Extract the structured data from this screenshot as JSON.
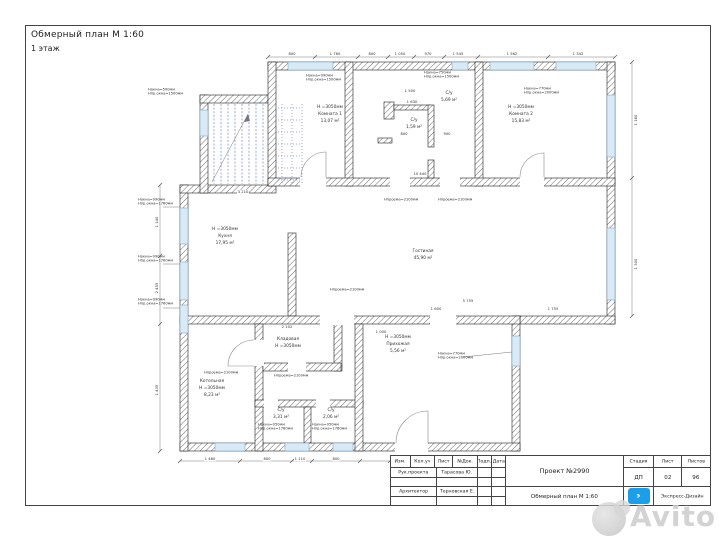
{
  "doc": {
    "title": "Обмерный план М 1:60",
    "subtitle": "1 этаж"
  },
  "plan": {
    "rooms": [
      {
        "l1": "Н =3050мм",
        "l2": "Комната 1",
        "l3": "13,07 м²"
      },
      {
        "l1": "С/у",
        "l2": "1,59 м²"
      },
      {
        "l1": "С/у",
        "l2": "5,69 м²"
      },
      {
        "l1": "Н =3050мм",
        "l2": "Комната 2",
        "l3": "15,83 м²"
      },
      {
        "l1": "Н =3050мм",
        "l2": "Кухня",
        "l3": "17,95 м²"
      },
      {
        "l1": "Гостиная",
        "l2": "45,90 м²"
      },
      {
        "l1": "Кладовая",
        "l2": "Н =3050мм"
      },
      {
        "l1": "Котельная",
        "l2": "Н =3050мм",
        "l3": "8,23 м²"
      },
      {
        "l1": "С/у",
        "l2": "3,31 м²"
      },
      {
        "l1": "С/у",
        "l2": "2,06 м²"
      },
      {
        "l1": "Н =3050мм",
        "l2": "Прихожая",
        "l3": "5,56 м²"
      }
    ],
    "dimensions": [
      {
        "t": "800",
        "x": 292,
        "y": 54
      },
      {
        "t": "1 760",
        "x": 335,
        "y": 54
      },
      {
        "t": "800",
        "x": 372,
        "y": 54
      },
      {
        "t": "1 050",
        "x": 400,
        "y": 54
      },
      {
        "t": "970",
        "x": 428,
        "y": 54
      },
      {
        "t": "1 545",
        "x": 458,
        "y": 54
      },
      {
        "t": "1 562",
        "x": 512,
        "y": 54
      },
      {
        "t": "1 342",
        "x": 578,
        "y": 54
      },
      {
        "t": "1 160",
        "x": 636,
        "y": 120,
        "v": true
      },
      {
        "t": "1 300",
        "x": 636,
        "y": 264,
        "v": true
      },
      {
        "t": "1 140",
        "x": 157,
        "y": 222,
        "v": true
      },
      {
        "t": "2 455",
        "x": 157,
        "y": 288,
        "v": true
      },
      {
        "t": "1 435",
        "x": 157,
        "y": 390,
        "v": true
      },
      {
        "t": "1 480",
        "x": 210,
        "y": 459
      },
      {
        "t": "800",
        "x": 267,
        "y": 459
      },
      {
        "t": "1 110",
        "x": 300,
        "y": 459
      },
      {
        "t": "800",
        "x": 336,
        "y": 459
      },
      {
        "t": "10 440",
        "x": 420,
        "y": 174
      },
      {
        "t": "1 500",
        "x": 410,
        "y": 91
      },
      {
        "t": "1 630",
        "x": 412,
        "y": 102
      },
      {
        "t": "800",
        "x": 404,
        "y": 134
      },
      {
        "t": "900",
        "x": 447,
        "y": 134
      },
      {
        "t": "2 102",
        "x": 287,
        "y": 327
      },
      {
        "t": "3 210",
        "x": 243,
        "y": 192
      },
      {
        "t": "5 755",
        "x": 468,
        "y": 301
      },
      {
        "t": "1 600",
        "x": 436,
        "y": 309
      },
      {
        "t": "1 755",
        "x": 553,
        "y": 309
      },
      {
        "t": "1 000",
        "x": 381,
        "y": 332
      }
    ],
    "annotations": [
      {
        "x": 306,
        "y": 74,
        "l1": "Hокна=990мм",
        "l2": "Hпр.окна=1500мм"
      },
      {
        "x": 424,
        "y": 71,
        "l1": "Hокна=750мм",
        "l2": "Hпр.окна=1500мм"
      },
      {
        "x": 524,
        "y": 87,
        "l1": "Hокна=770мм",
        "l2": "Hпр.окна=2000мм"
      },
      {
        "x": 138,
        "y": 198,
        "l1": "Hокна=990мм",
        "l2": "Hпр.окна=1760мм"
      },
      {
        "x": 138,
        "y": 255,
        "l1": "Hокна=990мм",
        "l2": "Hпр.окна=1760мм"
      },
      {
        "x": 138,
        "y": 298,
        "l1": "Hокна=990мм",
        "l2": "Hпр.окна=1760мм"
      },
      {
        "x": 148,
        "y": 88,
        "l1": "Hокна=500мм",
        "l2": "Hпр.окна=1500мм"
      },
      {
        "x": 384,
        "y": 198,
        "l1": "Hпроема=2100мм"
      },
      {
        "x": 438,
        "y": 198,
        "l1": "Hпроема=2100мм"
      },
      {
        "x": 330,
        "y": 288,
        "l1": "Hпроема=2100мм"
      },
      {
        "x": 204,
        "y": 371,
        "l1": "Hпроема=2100мм"
      },
      {
        "x": 274,
        "y": 374,
        "l1": "Hпроема=2100мм"
      },
      {
        "x": 438,
        "y": 352,
        "l1": "Hокна=770мм",
        "l2": "Hпр.окна=2000мм"
      },
      {
        "x": 258,
        "y": 423,
        "l1": "Hокна=950мм",
        "l2": "Hпр.окна=1760мм"
      },
      {
        "x": 312,
        "y": 423,
        "l1": "Hокна=950мм",
        "l2": "Hпр.окна=1760мм"
      }
    ]
  },
  "titleblock": {
    "header_cols": [
      "Изм.",
      "Кол.уч",
      "Лист",
      "№Док.",
      "Подп.",
      "Дата"
    ],
    "row1_role": "Рук.проекта",
    "row1_name": "Тарасова Ю.",
    "row2_role": "Архитектор",
    "row2_name": "Терновская Е.",
    "project": "Проект №2990",
    "doc_title": "Обмерный план М 1:60",
    "stage_label": "Стадия",
    "sheet_label": "Лист",
    "sheets_label": "Листов",
    "stage": "ДП",
    "sheet": "02",
    "sheets": "96",
    "logo_letter": "Э",
    "company": "Экспресс-Дизайн",
    "accent_color": "#1b9fe8"
  },
  "watermark": {
    "text": "Avito"
  }
}
